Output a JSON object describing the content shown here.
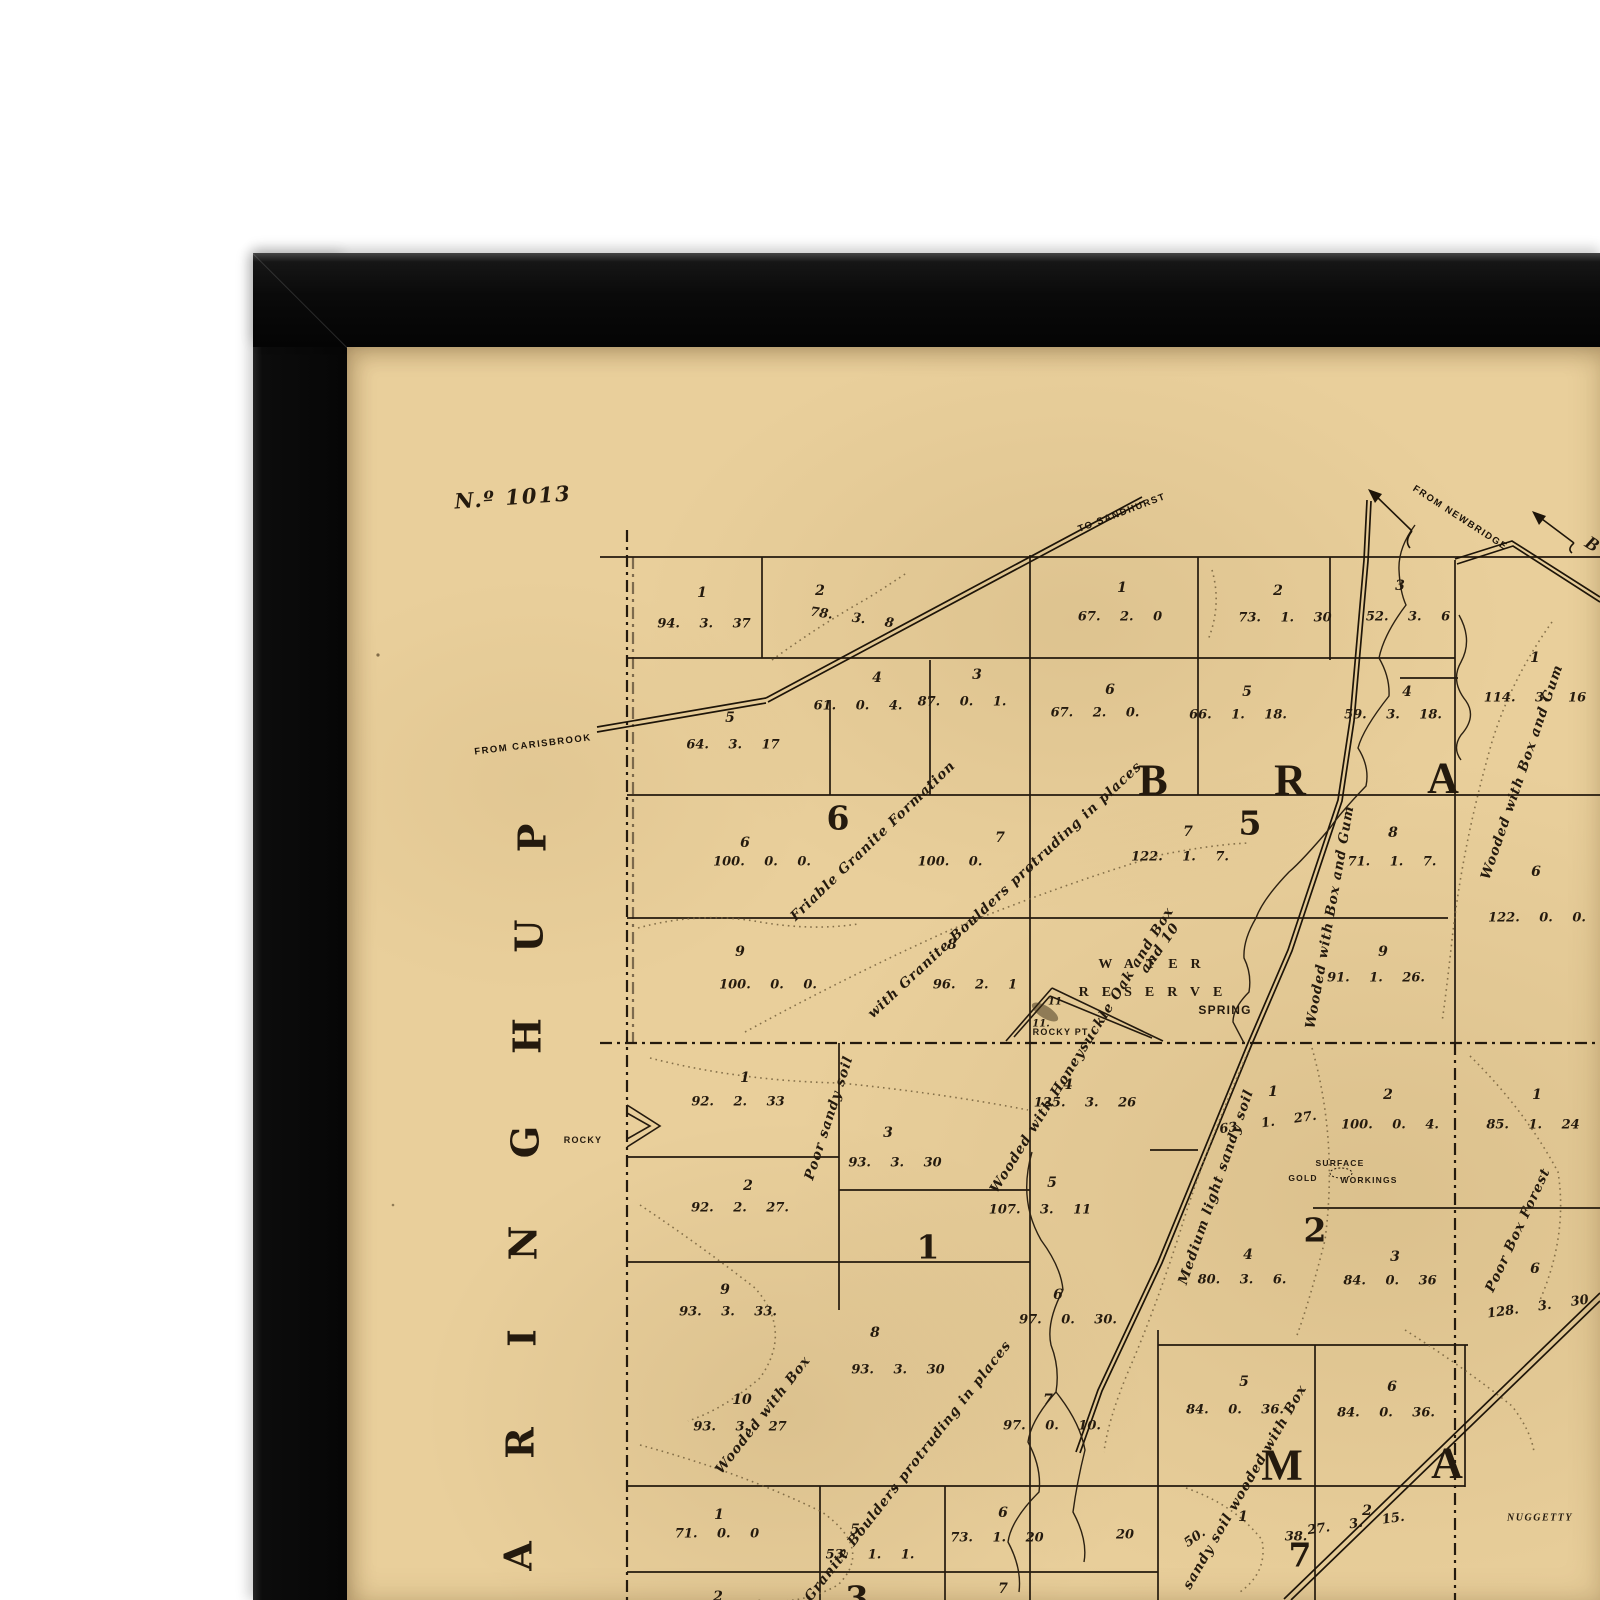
{
  "window": {
    "width": 1600,
    "height": 1600
  },
  "frame": {
    "description": "black picture frame, top-left corner visible",
    "color": "#0b0b0b"
  },
  "colors": {
    "paper": "#e9cf9b",
    "ink": "#241a0e",
    "track": "#74603c",
    "creek": "#2c2112"
  },
  "sheet": {
    "number": "N.º 1013"
  },
  "map": {
    "road_labels": [
      {
        "t": "FROM CARISBROOK",
        "x": 533,
        "y": 745,
        "r": -7
      },
      {
        "t": "TO SANDHURST",
        "x": 1122,
        "y": 513,
        "r": -21
      },
      {
        "t": "FROM NEWBRIDGE",
        "x": 1460,
        "y": 518,
        "r": 33
      }
    ],
    "destination_partial": [
      {
        "t": "B",
        "x": 1592,
        "y": 545,
        "r": 32
      }
    ],
    "place_labels": [
      {
        "t": "SPRING",
        "x": 1225,
        "y": 1010,
        "s": 12
      },
      {
        "t": "ROCKY PT.",
        "x": 1062,
        "y": 1032,
        "s": 9
      },
      {
        "t": "ROCKY",
        "x": 583,
        "y": 1140,
        "s": 9
      },
      {
        "t": "SURFACE",
        "x": 1340,
        "y": 1163,
        "s": 8.5
      },
      {
        "t": "GOLD",
        "x": 1303,
        "y": 1178,
        "s": 8.5
      },
      {
        "t": "WORKINGS",
        "x": 1369,
        "y": 1180,
        "s": 8.5
      },
      {
        "t": "NUGGETTY",
        "x": 1540,
        "y": 1518,
        "s": 10,
        "c": "place-it"
      }
    ],
    "reserve_labels": [
      {
        "t": "WATER",
        "x": 1156,
        "y": 965
      },
      {
        "t": "RESERVE",
        "x": 1157,
        "y": 993
      }
    ],
    "section_numbers": [
      {
        "t": "6",
        "x": 838,
        "y": 818
      },
      {
        "t": "5",
        "x": 1250,
        "y": 823
      },
      {
        "t": "1",
        "x": 928,
        "y": 1247
      },
      {
        "t": "2",
        "x": 1315,
        "y": 1230
      },
      {
        "t": "7",
        "x": 1300,
        "y": 1555
      },
      {
        "t": "3",
        "x": 857,
        "y": 1598
      }
    ],
    "parish_letters": [
      {
        "t": "B",
        "x": 1153,
        "y": 780
      },
      {
        "t": "R",
        "x": 1290,
        "y": 780
      },
      {
        "t": "A",
        "x": 1443,
        "y": 778
      },
      {
        "t": "M",
        "x": 1282,
        "y": 1465
      },
      {
        "t": "A",
        "x": 1447,
        "y": 1463
      }
    ],
    "margin_letters": [
      {
        "t": "P",
        "x": 532,
        "y": 838,
        "r": -90
      },
      {
        "t": "U",
        "x": 529,
        "y": 936,
        "r": -90
      },
      {
        "t": "H",
        "x": 527,
        "y": 1036,
        "r": -90
      },
      {
        "t": "G",
        "x": 525,
        "y": 1142,
        "r": -90
      },
      {
        "t": "N",
        "x": 523,
        "y": 1243,
        "r": -90
      },
      {
        "t": "I",
        "x": 522,
        "y": 1338,
        "r": -90
      },
      {
        "t": "R",
        "x": 520,
        "y": 1443,
        "r": -90
      },
      {
        "t": "A",
        "x": 518,
        "y": 1556,
        "r": -90
      }
    ],
    "lot_numbers": [
      {
        "t": "1",
        "x": 702,
        "y": 593
      },
      {
        "t": "2",
        "x": 820,
        "y": 591
      },
      {
        "t": "4",
        "x": 877,
        "y": 678
      },
      {
        "t": "3",
        "x": 977,
        "y": 675
      },
      {
        "t": "5",
        "x": 730,
        "y": 718
      },
      {
        "t": "1",
        "x": 1122,
        "y": 588
      },
      {
        "t": "2",
        "x": 1278,
        "y": 591
      },
      {
        "t": "3",
        "x": 1400,
        "y": 586
      },
      {
        "t": "6",
        "x": 1110,
        "y": 690
      },
      {
        "t": "5",
        "x": 1247,
        "y": 692
      },
      {
        "t": "4",
        "x": 1407,
        "y": 692
      },
      {
        "t": "1",
        "x": 1535,
        "y": 658
      },
      {
        "t": "6",
        "x": 1536,
        "y": 872
      },
      {
        "t": "6",
        "x": 745,
        "y": 843
      },
      {
        "t": "7",
        "x": 1000,
        "y": 838
      },
      {
        "t": "9",
        "x": 740,
        "y": 952
      },
      {
        "t": "8",
        "x": 952,
        "y": 945
      },
      {
        "t": "7",
        "x": 1188,
        "y": 832
      },
      {
        "t": "8",
        "x": 1393,
        "y": 833
      },
      {
        "t": "9",
        "x": 1383,
        "y": 952
      },
      {
        "t": "1",
        "x": 745,
        "y": 1078
      },
      {
        "t": "3",
        "x": 888,
        "y": 1133
      },
      {
        "t": "4",
        "x": 1068,
        "y": 1085
      },
      {
        "t": "2",
        "x": 748,
        "y": 1186
      },
      {
        "t": "5",
        "x": 1052,
        "y": 1183
      },
      {
        "t": "9",
        "x": 725,
        "y": 1290
      },
      {
        "t": "8",
        "x": 875,
        "y": 1333
      },
      {
        "t": "6",
        "x": 1058,
        "y": 1295
      },
      {
        "t": "10",
        "x": 742,
        "y": 1400
      },
      {
        "t": "7",
        "x": 1048,
        "y": 1400
      },
      {
        "t": "1",
        "x": 1273,
        "y": 1092
      },
      {
        "t": "2",
        "x": 1388,
        "y": 1095
      },
      {
        "t": "1",
        "x": 1537,
        "y": 1095
      },
      {
        "t": "4",
        "x": 1248,
        "y": 1255
      },
      {
        "t": "3",
        "x": 1395,
        "y": 1257
      },
      {
        "t": "6",
        "x": 1535,
        "y": 1269
      },
      {
        "t": "5",
        "x": 1244,
        "y": 1382
      },
      {
        "t": "6",
        "x": 1392,
        "y": 1387
      },
      {
        "t": "1",
        "x": 719,
        "y": 1515
      },
      {
        "t": "5",
        "x": 855,
        "y": 1530
      },
      {
        "t": "6",
        "x": 1003,
        "y": 1513
      },
      {
        "t": "1",
        "x": 1243,
        "y": 1517
      },
      {
        "t": "2",
        "x": 1367,
        "y": 1511
      },
      {
        "t": "7",
        "x": 1003,
        "y": 1589
      },
      {
        "t": "2",
        "x": 718,
        "y": 1597
      }
    ],
    "area_values": [
      {
        "t": "94. 3. 37",
        "x": 704,
        "y": 624
      },
      {
        "t": "78. 3. 8",
        "x": 852,
        "y": 618,
        "r": 8
      },
      {
        "t": "61. 0. 4.",
        "x": 858,
        "y": 706
      },
      {
        "t": "87. 0. 1.",
        "x": 962,
        "y": 702
      },
      {
        "t": "64. 3. 17",
        "x": 733,
        "y": 745
      },
      {
        "t": "67. 2. 0",
        "x": 1120,
        "y": 617
      },
      {
        "t": "73. 1. 30",
        "x": 1285,
        "y": 618
      },
      {
        "t": "52. 3. 6",
        "x": 1408,
        "y": 617
      },
      {
        "t": "67. 2. 0.",
        "x": 1095,
        "y": 713
      },
      {
        "t": "66. 1. 18.",
        "x": 1238,
        "y": 715
      },
      {
        "t": "59. 3. 18.",
        "x": 1393,
        "y": 715
      },
      {
        "t": "114. 3. 16",
        "x": 1535,
        "y": 698
      },
      {
        "t": "122. 0. 0.",
        "x": 1537,
        "y": 918
      },
      {
        "t": "100. 0. 0.",
        "x": 762,
        "y": 862
      },
      {
        "t": "100. 0.",
        "x": 950,
        "y": 862
      },
      {
        "t": "100. 0. 0.",
        "x": 768,
        "y": 985
      },
      {
        "t": "96. 2. 1",
        "x": 975,
        "y": 985
      },
      {
        "t": "122. 1. 7.",
        "x": 1180,
        "y": 857
      },
      {
        "t": "71. 1. 7.",
        "x": 1392,
        "y": 862
      },
      {
        "t": "91. 1. 26.",
        "x": 1376,
        "y": 978
      },
      {
        "t": "92. 2. 33",
        "x": 738,
        "y": 1102
      },
      {
        "t": "93. 3. 30",
        "x": 895,
        "y": 1163
      },
      {
        "t": "125. 3. 26",
        "x": 1085,
        "y": 1103
      },
      {
        "t": "92. 2. 27.",
        "x": 740,
        "y": 1208
      },
      {
        "t": "107. 3. 11",
        "x": 1040,
        "y": 1210
      },
      {
        "t": "93. 3. 33.",
        "x": 728,
        "y": 1312
      },
      {
        "t": "93. 3. 30",
        "x": 898,
        "y": 1370
      },
      {
        "t": "97. 0. 30.",
        "x": 1068,
        "y": 1320
      },
      {
        "t": "93. 3. 27",
        "x": 740,
        "y": 1427
      },
      {
        "t": "97. 0. 10.",
        "x": 1052,
        "y": 1426
      },
      {
        "t": "63. 1. 27.",
        "x": 1268,
        "y": 1123,
        "r": -8
      },
      {
        "t": "100. 0. 4.",
        "x": 1390,
        "y": 1125
      },
      {
        "t": "85. 1. 24",
        "x": 1533,
        "y": 1125
      },
      {
        "t": "80. 3. 6.",
        "x": 1242,
        "y": 1280
      },
      {
        "t": "84. 0. 36",
        "x": 1390,
        "y": 1281
      },
      {
        "t": "128. 3. 30",
        "x": 1538,
        "y": 1307,
        "r": -8
      },
      {
        "t": "84. 0. 36.",
        "x": 1235,
        "y": 1410
      },
      {
        "t": "84. 0. 36.",
        "x": 1386,
        "y": 1413
      },
      {
        "t": "71. 0. 0",
        "x": 717,
        "y": 1534
      },
      {
        "t": "53. 1. 1.",
        "x": 870,
        "y": 1555
      },
      {
        "t": "73. 1. 20",
        "x": 997,
        "y": 1538
      },
      {
        "t": "27. 3. 15.",
        "x": 1356,
        "y": 1524,
        "r": -8
      },
      {
        "t": "50.",
        "x": 1195,
        "y": 1538,
        "r": -35
      },
      {
        "t": "38.",
        "x": 1296,
        "y": 1537
      },
      {
        "t": "20",
        "x": 1125,
        "y": 1535
      }
    ],
    "annotations": [
      {
        "t": "Friable Granite Formation",
        "x": 873,
        "y": 841,
        "r": -44
      },
      {
        "t": "with Granite Boulders protruding in places",
        "x": 1005,
        "y": 890,
        "r": -43
      },
      {
        "t": "Poor sandy soil",
        "x": 829,
        "y": 1118,
        "r": -72
      },
      {
        "t": "Wooded with Honeysuckle Oak and Box",
        "x": 1082,
        "y": 1050,
        "r": -58
      },
      {
        "t": "and 10",
        "x": 1160,
        "y": 948,
        "r": -55
      },
      {
        "t": "Wooded with Box and Gum",
        "x": 1330,
        "y": 917,
        "r": -80
      },
      {
        "t": "Wooded with Box and Gum",
        "x": 1522,
        "y": 772,
        "r": -71
      },
      {
        "t": "Medium light sandy soil",
        "x": 1216,
        "y": 1187,
        "r": -71
      },
      {
        "t": "Poor Box Forest",
        "x": 1518,
        "y": 1230,
        "r": -65
      },
      {
        "t": "Wooded with Box",
        "x": 763,
        "y": 1415,
        "r": -52
      },
      {
        "t": "Granite Boulders protruding in places",
        "x": 908,
        "y": 1471,
        "r": -52
      },
      {
        "t": "sandy soil wooded with Box",
        "x": 1245,
        "y": 1487,
        "r": -60
      }
    ],
    "small_numbers": [
      {
        "t": "11",
        "x": 1055,
        "y": 1002
      },
      {
        "t": "11.",
        "x": 1041,
        "y": 1024
      }
    ]
  }
}
